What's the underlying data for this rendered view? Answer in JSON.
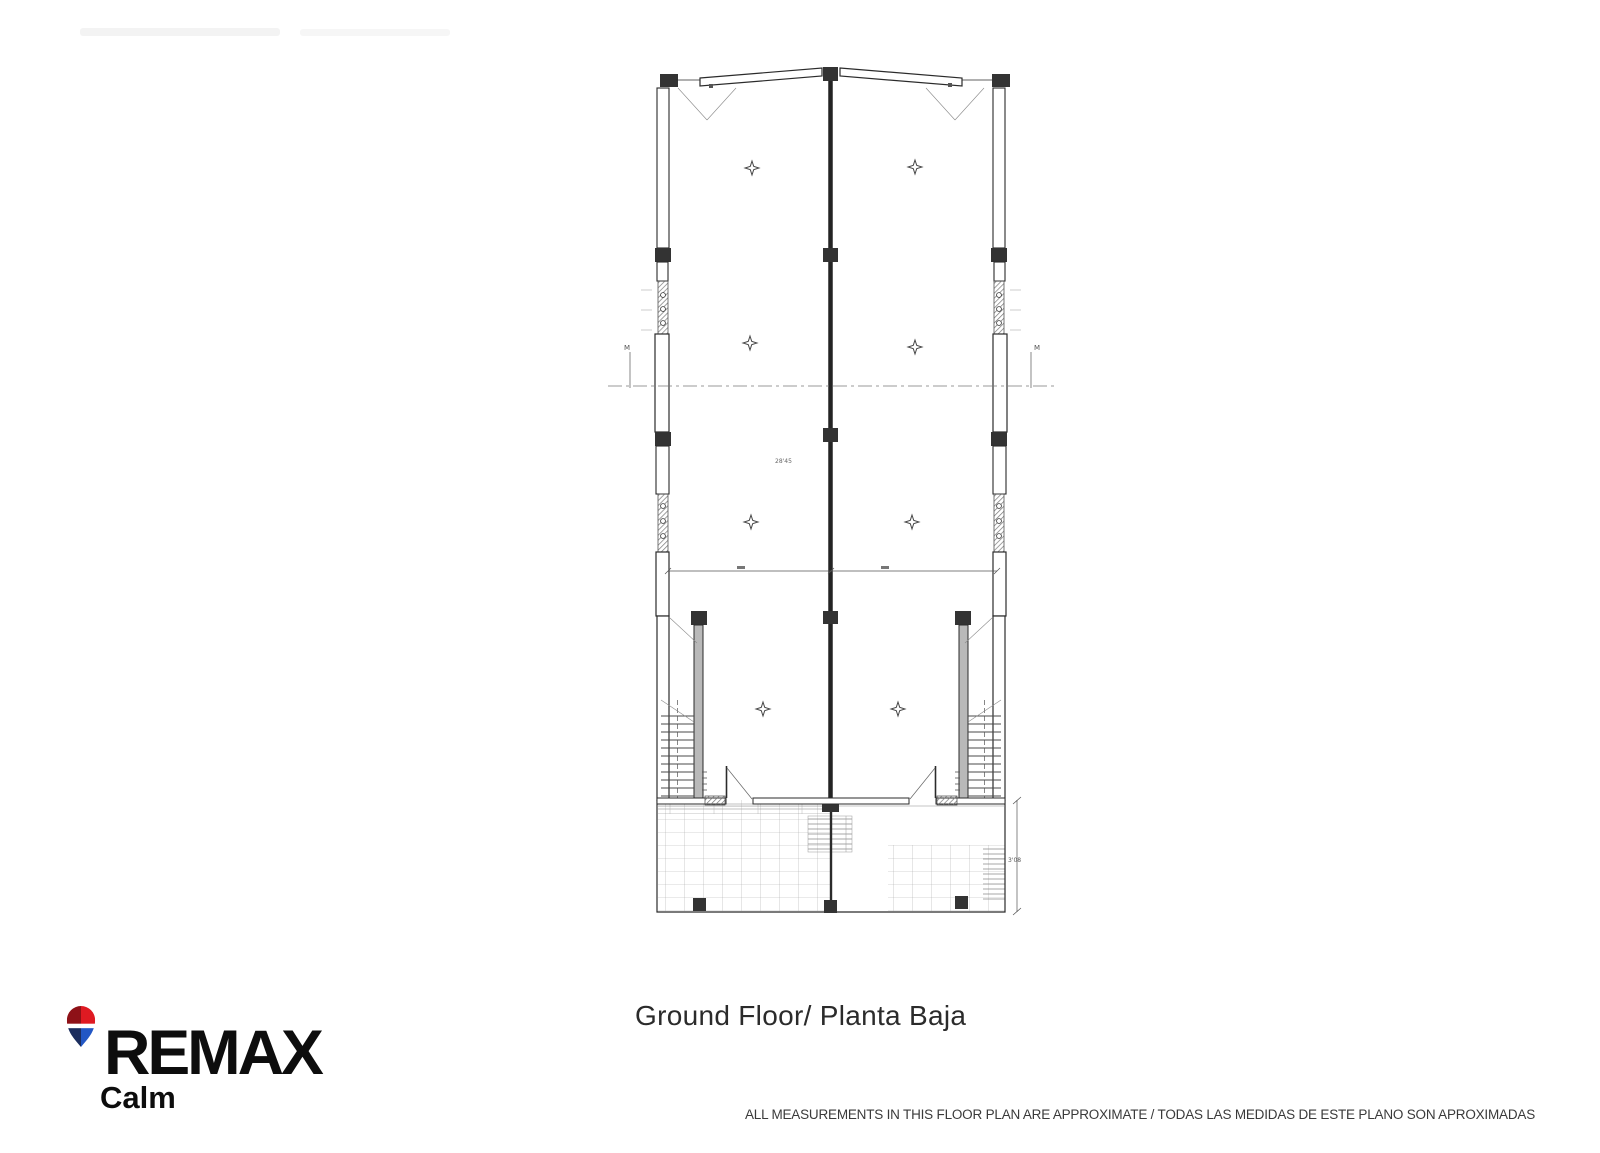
{
  "caption": {
    "text": "Ground Floor/ Planta Baja"
  },
  "disclaimer": {
    "text": "ALL MEASUREMENTS IN THIS FLOOR PLAN ARE APPROXIMATE / TODAS LAS MEDIDAS DE ESTE PLANO SON APROXIMADAS"
  },
  "brand": {
    "name": "REMAX",
    "office": "Calm",
    "balloon": {
      "red_light": "#df1a22",
      "red_dark": "#8e1117",
      "blue_light": "#2257c5",
      "blue_dark": "#1b2d5e",
      "band": "#ffffff"
    }
  },
  "plan": {
    "ink_color": "#2b2b2b",
    "annotations": {
      "interior_width": "28'45",
      "terrace_depth": "3'08",
      "left_section_marker": "M",
      "right_section_marker": "M"
    }
  }
}
